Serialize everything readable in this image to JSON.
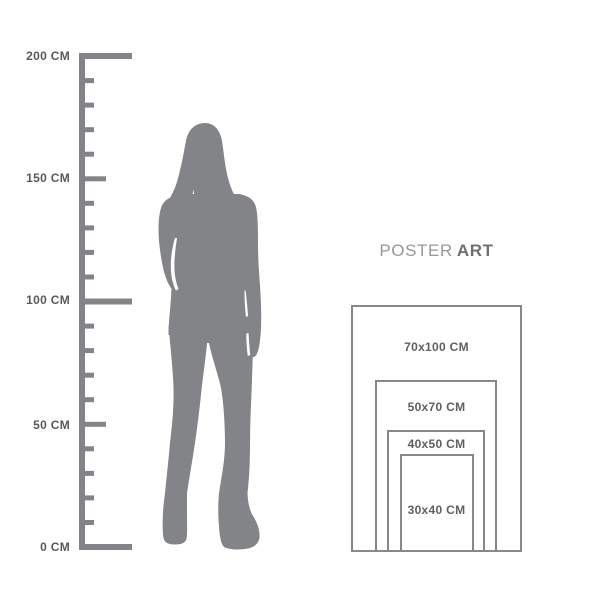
{
  "brand": {
    "regular": "POSTER",
    "bold": "ART"
  },
  "ruler": {
    "unit": "CM",
    "labels": [
      "200 CM",
      "150 CM",
      "100 CM",
      "50 CM",
      "0 CM"
    ]
  },
  "silhouette": {
    "icon": "standing-woman-silhouette"
  },
  "poster_sizes": [
    {
      "label": "70x100 CM"
    },
    {
      "label": "50x70 CM"
    },
    {
      "label": "40x50 CM"
    },
    {
      "label": "30x40 CM"
    }
  ],
  "colors": {
    "shape_gray": "#838488",
    "ruler_text": "#58595c",
    "poster_border": "#87888c",
    "poster_text": "#5f6063",
    "title_regular": "#97989b",
    "title_bold": "#6f7073"
  }
}
